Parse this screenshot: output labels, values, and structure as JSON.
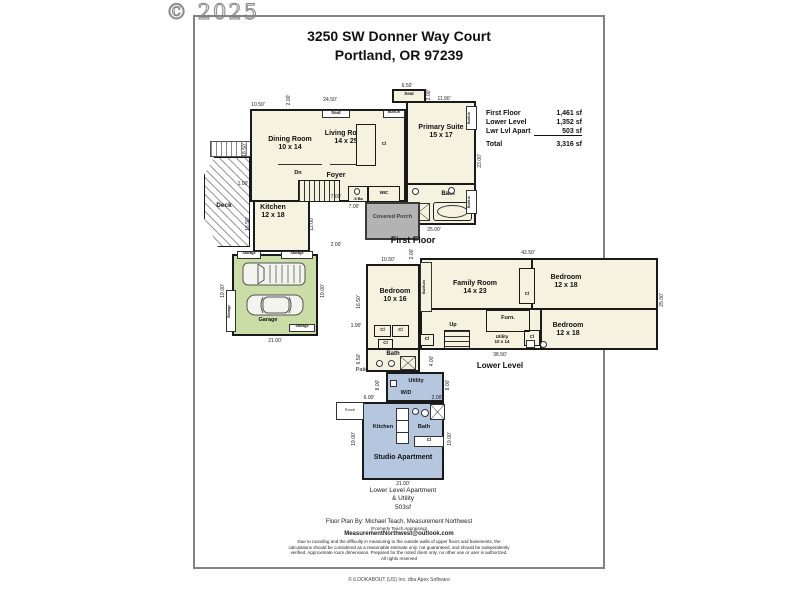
{
  "watermark": "© 2025",
  "header": {
    "address_line1": "3250 SW Donner Way Court",
    "address_line2": "Portland, OR 97239"
  },
  "area_summary": {
    "rows": [
      {
        "label": "First Floor",
        "value": "1,461 sf"
      },
      {
        "label": "Lower Level",
        "value": "1,352 sf"
      },
      {
        "label": "Lwr Lvl Apart",
        "value": "503 sf"
      }
    ],
    "total": {
      "label": "Total",
      "value": "3,316 sf"
    }
  },
  "first_floor": {
    "caption": "First Floor",
    "rooms": {
      "dining": {
        "name": "Dining Room",
        "size": "10 x 14"
      },
      "living": {
        "name": "Living Room",
        "size": "14 x 25"
      },
      "primary": {
        "name": "Primary Suite",
        "size": "15 x 17"
      },
      "kitchen": {
        "name": "Kitchen",
        "size": "12 x 18"
      }
    },
    "labels": {
      "foyer": "Foyer",
      "deck": "Deck",
      "bath": "Bath",
      "wic": "WIC",
      "half_bath": ".5 Ba",
      "dn": "Dn",
      "covered_porch": "Covered Porch",
      "seat_primary": "Seat",
      "seat_living": "Seat",
      "built_in": "Built-in",
      "built_in_side1": "Built-in",
      "built_in_side2": "Built-in",
      "closet": "Cl"
    },
    "dims": [
      "10.50'",
      "2.00'",
      "24.50'",
      "6.50'",
      "11.90'",
      "18.50'",
      "23.00'",
      "25.00'",
      "7.00'",
      "7.00'",
      "2.00'",
      "1.00'",
      "16.50'",
      "12.00'",
      "2.00'"
    ]
  },
  "garage": {
    "label": "Garage",
    "storage_top_left": "Storage",
    "storage_top_right": "Storage",
    "storage_left": "Storage",
    "storage_bottom": "Storage",
    "dims": [
      "21.00'",
      "19.00'",
      "19.00'"
    ]
  },
  "lower_level": {
    "caption": "Lower Level",
    "rooms": {
      "bedroom_left": {
        "name": "Bedroom",
        "size": "10 x 16"
      },
      "family": {
        "name": "Family Room",
        "size": "14 x 23"
      },
      "bedroom_top_right": {
        "name": "Bedroom",
        "size": "12 x 18"
      },
      "bedroom_bottom_right": {
        "name": "Bedroom",
        "size": "12 x 18"
      },
      "utility": {
        "name": "Utility",
        "size": "10 x 14"
      }
    },
    "labels": {
      "up": "Up",
      "furnace": "Furn.",
      "bath": "Bath",
      "patio": "Patio",
      "built_in": "Built-in",
      "cl1": "Cl",
      "cl2": "Cl",
      "cl3": "Cl",
      "cl_hall": "Cl",
      "cl_family": "Cl",
      "cl_bedroom": "Cl"
    },
    "dims": [
      "10.50'",
      "2.00'",
      "42.50'",
      "16.50'",
      "1.90'",
      "6.50'",
      "4.00'",
      "25.00'",
      "38.50'"
    ]
  },
  "studio": {
    "labels": {
      "utility": "Utility",
      "wd": "W/D",
      "porch": "Porch",
      "kitchen": "Kitchen",
      "bath": "Bath",
      "closet": "Cl",
      "studio": "Studio Apartment"
    },
    "caption": {
      "line1": "Lower Level Apartment",
      "line2": "& Utility",
      "line3": "503sf"
    },
    "dims": [
      "8.00'",
      "8.00'",
      "6.00'",
      "2.00'",
      "19.00'",
      "19.00'",
      "21.00'"
    ]
  },
  "footer": {
    "by_line": "Floor Plan By: Michael Teach, Measurement Northwest",
    "formerly": "(Formerly Teach Appraising)",
    "email": "MeasurementNorthwest@outlook.com",
    "disclaimer": "Due to rounding and the difficulty in measuring to the outside walls of upper floors and basements, the calculations should be considered as a reasonable estimate only, not guaranteed, and should be independently verified. Approximate room dimensions. Prepared for the noted client only, no other use or user is authorized. All rights reserved",
    "copyright": "© iLOOKABOUT (US) Inc. dba Apex Software"
  },
  "colors": {
    "floor": "#f6f2e0",
    "garage": "#cbdda6",
    "studio": "#b5c7df",
    "porch": "#b3b3b3",
    "wall": "#1a1a1a",
    "page_border": "#828282"
  }
}
